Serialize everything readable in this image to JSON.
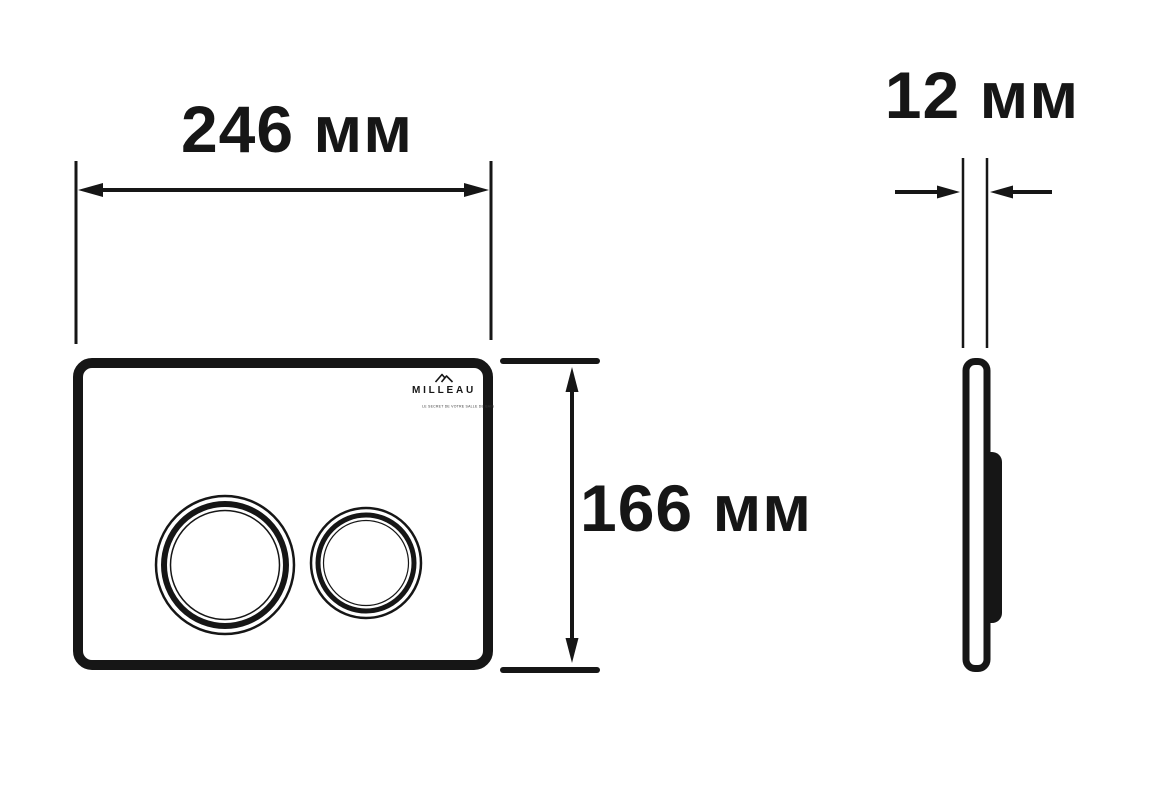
{
  "page": {
    "background": "#ffffff",
    "ink": "#161616",
    "description_labels_language": "ru"
  },
  "brand": {
    "name": "MILLEAU",
    "tagline": "LE SECRET DE VOTRE SALLE DE BAIN"
  },
  "dimensions": {
    "width": {
      "value": 246,
      "unit": "мм",
      "label": "246 мм"
    },
    "height": {
      "value": 166,
      "unit": "мм",
      "label": "166 мм"
    },
    "depth": {
      "value": 12,
      "unit": "мм",
      "label": "12 мм"
    }
  }
}
